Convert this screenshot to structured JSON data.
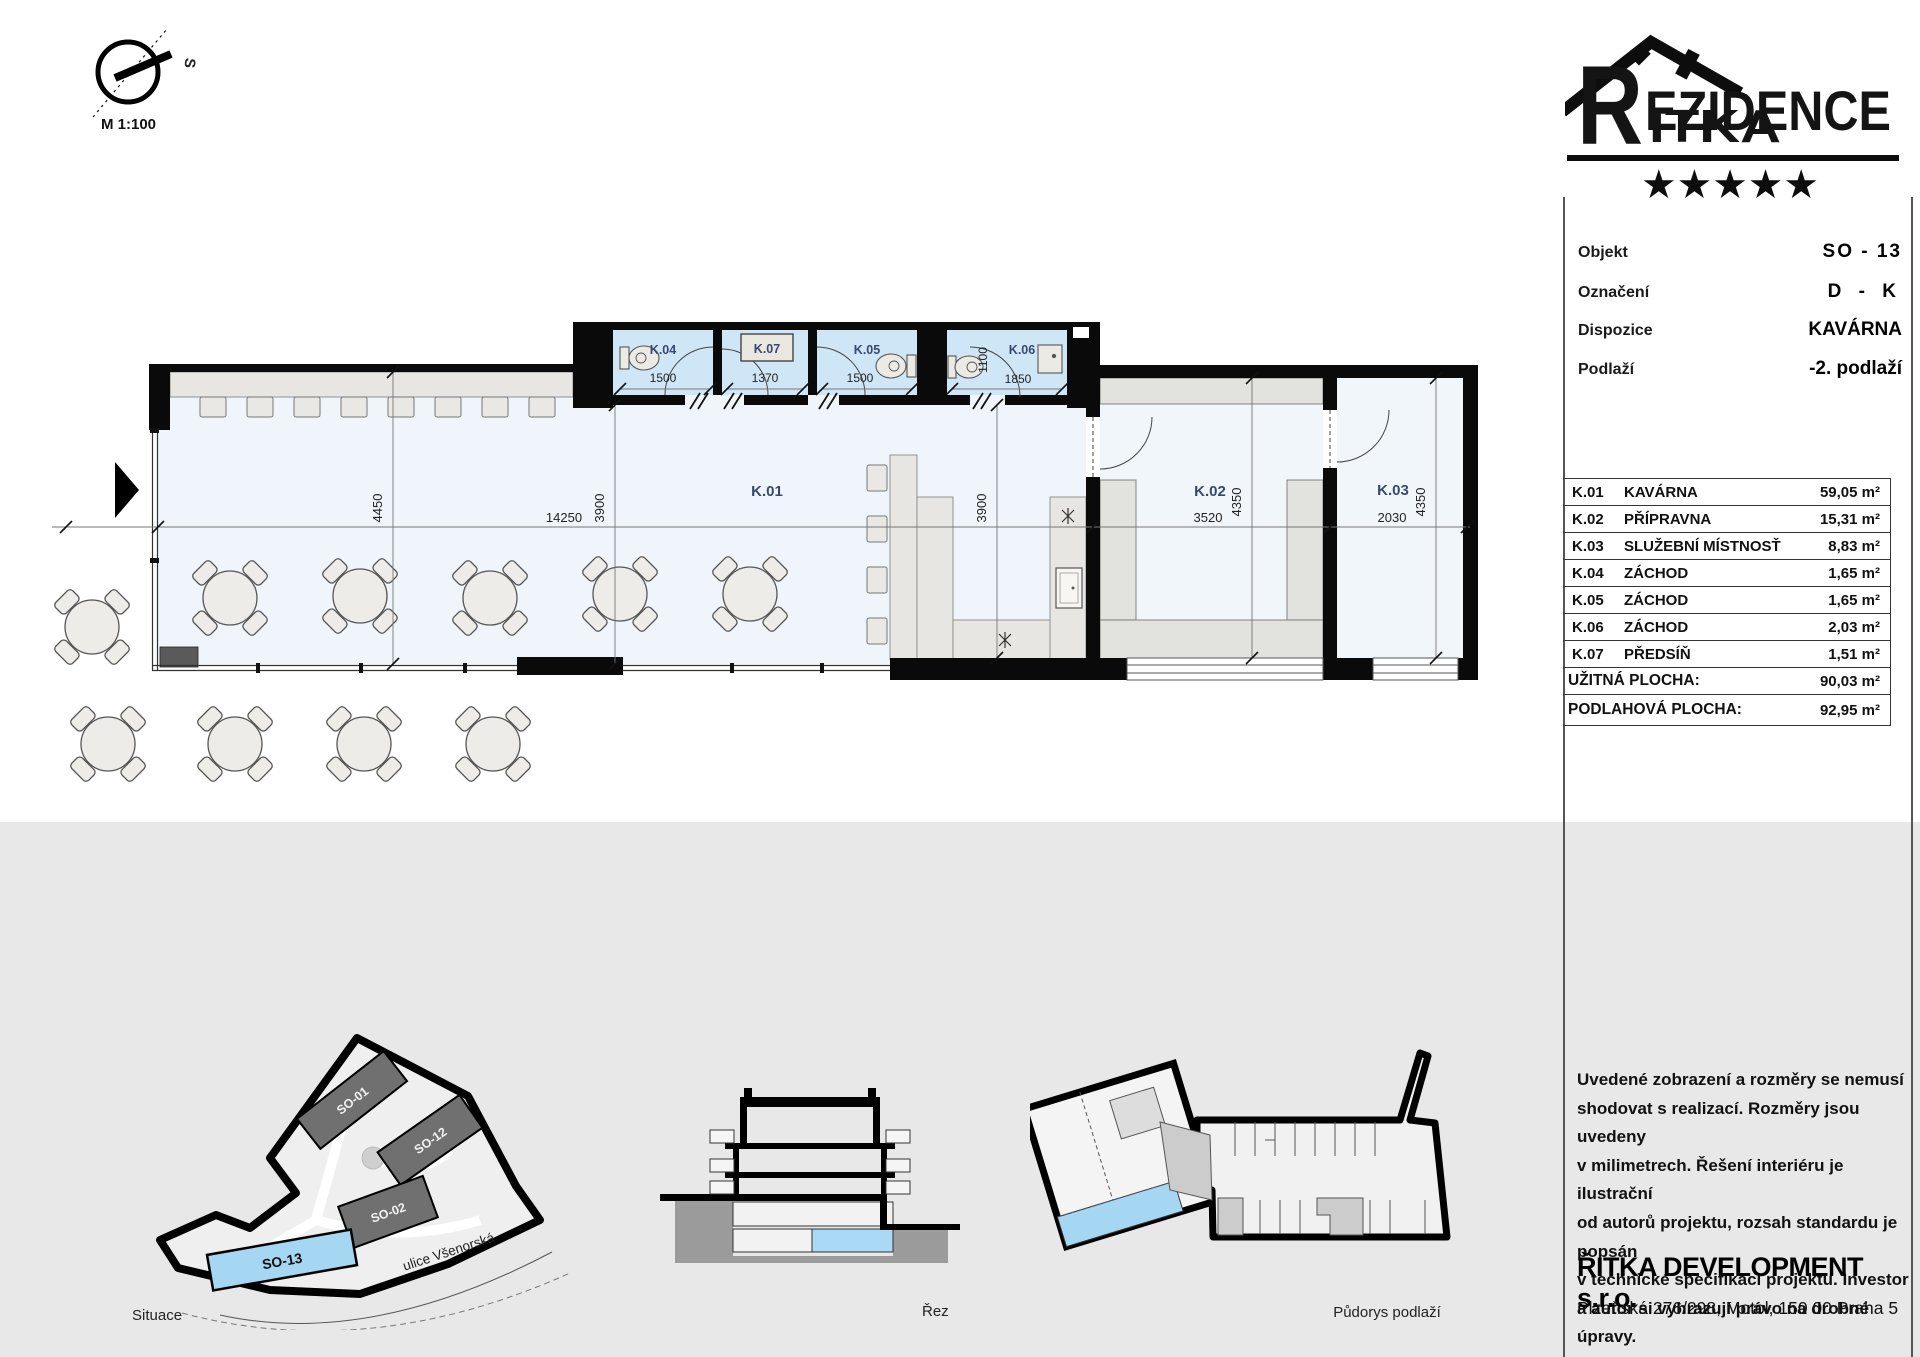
{
  "compass": {
    "north": "S",
    "scale": "M 1:100"
  },
  "logo": {
    "initial": "R",
    "word_top": "EZIDENCE",
    "word_bottom": "ITKA",
    "stars": "★★★★★"
  },
  "info": {
    "rows": [
      {
        "label": "Objekt",
        "value": "SO - 13"
      },
      {
        "label": "Označení",
        "value": "D - K"
      },
      {
        "label": "Dispozice",
        "value": "KAVÁRNA"
      },
      {
        "label": "Podlaží",
        "value": "-2. podlaží"
      }
    ]
  },
  "area_table": {
    "rooms": [
      {
        "code": "K.01",
        "name": "KAVÁRNA",
        "area": "59,05 m²"
      },
      {
        "code": "K.02",
        "name": "PŘÍPRAVNA",
        "area": "15,31 m²"
      },
      {
        "code": "K.03",
        "name": "SLUŽEBNÍ MÍSTNOSŤ",
        "area": "8,83 m²"
      },
      {
        "code": "K.04",
        "name": "ZÁCHOD",
        "area": "1,65 m²"
      },
      {
        "code": "K.05",
        "name": "ZÁCHOD",
        "area": "1,65 m²"
      },
      {
        "code": "K.06",
        "name": "ZÁCHOD",
        "area": "2,03 m²"
      },
      {
        "code": "K.07",
        "name": "PŘEDSÍŇ",
        "area": "1,51 m²"
      }
    ],
    "totals": [
      {
        "label": "UŽITNÁ PLOCHA:",
        "value": "90,03 m²"
      },
      {
        "label": "PODLAHOVÁ PLOCHA:",
        "value": "92,95 m²"
      }
    ]
  },
  "plan": {
    "rooms": {
      "k01": "K.01",
      "k02": "K.02",
      "k03": "K.03"
    },
    "bath": [
      {
        "label": "K.04",
        "dim": "1500"
      },
      {
        "label": "K.07",
        "dim": "1370"
      },
      {
        "label": "K.05",
        "dim": "1500"
      },
      {
        "label": "K.06",
        "dim": "1850",
        "vdim": "1100"
      }
    ],
    "dims": {
      "d4450": "4450",
      "d14250": "14250",
      "d3900": "3900",
      "d3900b": "3900",
      "d3520": "3520",
      "d4350a": "4350",
      "d2030": "2030",
      "d4350b": "4350"
    }
  },
  "footer": {
    "situace_label": "Situace",
    "rez_label": "Řez",
    "pudorys_label": "Půdorys podlaží",
    "street": "ulice Všenorská",
    "buildings": [
      "SO-01",
      "SO-12",
      "SO-02",
      "SO-13"
    ]
  },
  "disclaimer": {
    "lines": [
      "Uvedené zobrazení a rozměry se nemusí",
      "shodovat s realizací. Rozměry jsou uvedeny",
      "v milimetrech. Řešení interiéru je ilustrační",
      "od autorů projektu, rozsah standardu je popsán",
      "v technické specifikaci projektu. Investor",
      "a autor si vyhrazují právo na drobné úpravy."
    ]
  },
  "company": {
    "name": "ŘITKA DEVELOPMENT s.r.o.",
    "address": "Plzeňská 276/298, Motol, 150 00 Praha 5"
  }
}
